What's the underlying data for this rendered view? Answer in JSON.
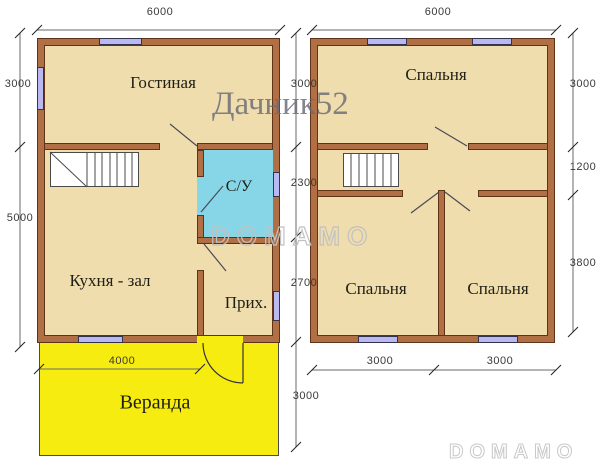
{
  "watermarks": {
    "brand_name": "Дачник52",
    "brand_center": "DOMAMO",
    "brand_bottom": "DOMAMO"
  },
  "floor1": {
    "rooms": {
      "living": "Гостиная",
      "bathroom": "С/У",
      "kitchen": "Кухня - зал",
      "hall": "Прих.",
      "veranda": "Веранда"
    },
    "dims": {
      "top": "6000",
      "left_upper": "3000",
      "left_lower": "5000",
      "right_upper": "3000",
      "right_bath": "2300",
      "right_hall": "2700",
      "right_veranda": "3000",
      "veranda_width": "4000"
    }
  },
  "floor2": {
    "rooms": {
      "bedroom_top": "Спальня",
      "bedroom_left": "Спальня",
      "bedroom_right": "Спальня"
    },
    "dims": {
      "top": "6000",
      "right_upper": "3000",
      "right_middle": "1200",
      "right_lower": "3800",
      "bottom_left": "3000",
      "bottom_right": "3000"
    }
  },
  "colors": {
    "wall": "#b06f45",
    "wall-dark": "#5e3317",
    "floor": "#efddae",
    "bath": "#86d6e7",
    "veranda": "#f7ec10",
    "window": "#b9b8f1",
    "line": "#4a4a4a",
    "dimtext": "#3a3a3a"
  }
}
